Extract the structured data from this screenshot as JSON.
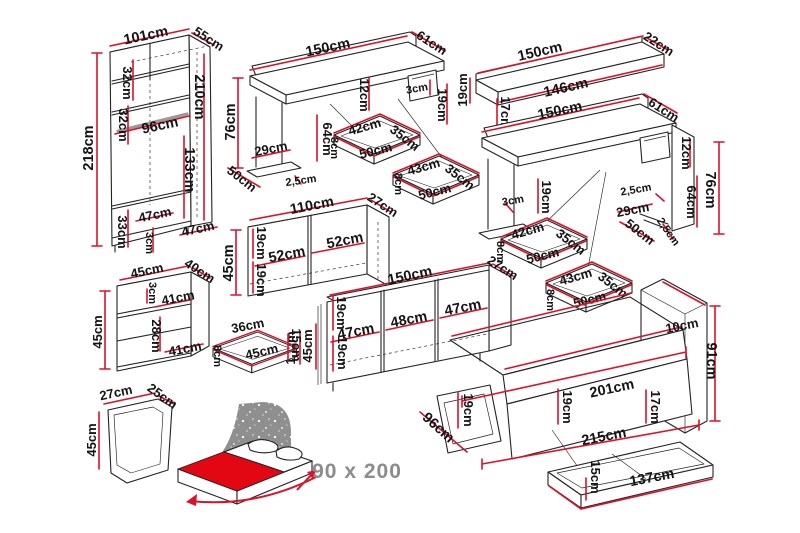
{
  "colors": {
    "dimension": "#d8132b",
    "outline": "#232323",
    "text": "#141414",
    "muted": "#8c8c8c",
    "bed_red": "#e30613",
    "headboard_grey": "#8f8f8f",
    "rail_grey": "#9a9a9a"
  },
  "pieces": {
    "wardrobe": {
      "labels": [
        "101cm",
        "55cm",
        "218cm",
        "32cm",
        "32cm",
        "210cm",
        "96cm",
        "133cm",
        "33cm",
        "47cm",
        "3cm",
        "47cm"
      ]
    },
    "desk_left": {
      "labels": [
        "150cm",
        "61cm",
        "76cm",
        "12cm",
        "3cm",
        "19cm",
        "64cm",
        "29cm",
        "2,5cm",
        "50cm"
      ]
    },
    "drawer_a": {
      "labels": [
        "42cm",
        "35cm",
        "50cm",
        "8cm"
      ]
    },
    "drawer_b": {
      "labels": [
        "43cm",
        "35cm",
        "50cm",
        "8cm"
      ]
    },
    "wall_shelf": {
      "labels": [
        "150cm",
        "22cm",
        "19cm",
        "146cm",
        "17cm"
      ]
    },
    "desk_right": {
      "labels": [
        "150cm",
        "61cm",
        "12cm",
        "64cm",
        "76cm",
        "2,5cm",
        "19cm",
        "3cm",
        "29cm",
        "50cm",
        "2,5cm"
      ]
    },
    "drawer_c": {
      "labels": [
        "42cm",
        "35cm",
        "50cm",
        "8cm"
      ]
    },
    "drawer_d": {
      "labels": [
        "43cm",
        "35cm",
        "50cm",
        "8cm"
      ]
    },
    "low_cabinet": {
      "labels": [
        "110cm",
        "27cm",
        "45cm",
        "19cm",
        "19cm",
        "52cm",
        "52cm"
      ]
    },
    "sideboard": {
      "labels": [
        "150cm",
        "27cm",
        "45cm",
        "15cm",
        "19cm",
        "19cm",
        "47cm",
        "48cm",
        "47cm"
      ]
    },
    "nightstand": {
      "labels": [
        "45cm",
        "40cm",
        "45cm",
        "3cm",
        "41cm",
        "28cm",
        "41cm"
      ]
    },
    "small_drawer": {
      "labels": [
        "36cm",
        "45cm",
        "8cm",
        "15cm"
      ]
    },
    "open_shelf": {
      "labels": [
        "27cm",
        "25cm",
        "45cm"
      ]
    },
    "bed": {
      "labels": [
        "10cm",
        "91cm",
        "201cm",
        "215cm",
        "19cm",
        "19cm",
        "17cm",
        "96cm"
      ]
    },
    "bed_drawer": {
      "labels": [
        "15cm",
        "137cm"
      ]
    },
    "bed_pictogram": {
      "size_label": "90 x 200"
    }
  }
}
